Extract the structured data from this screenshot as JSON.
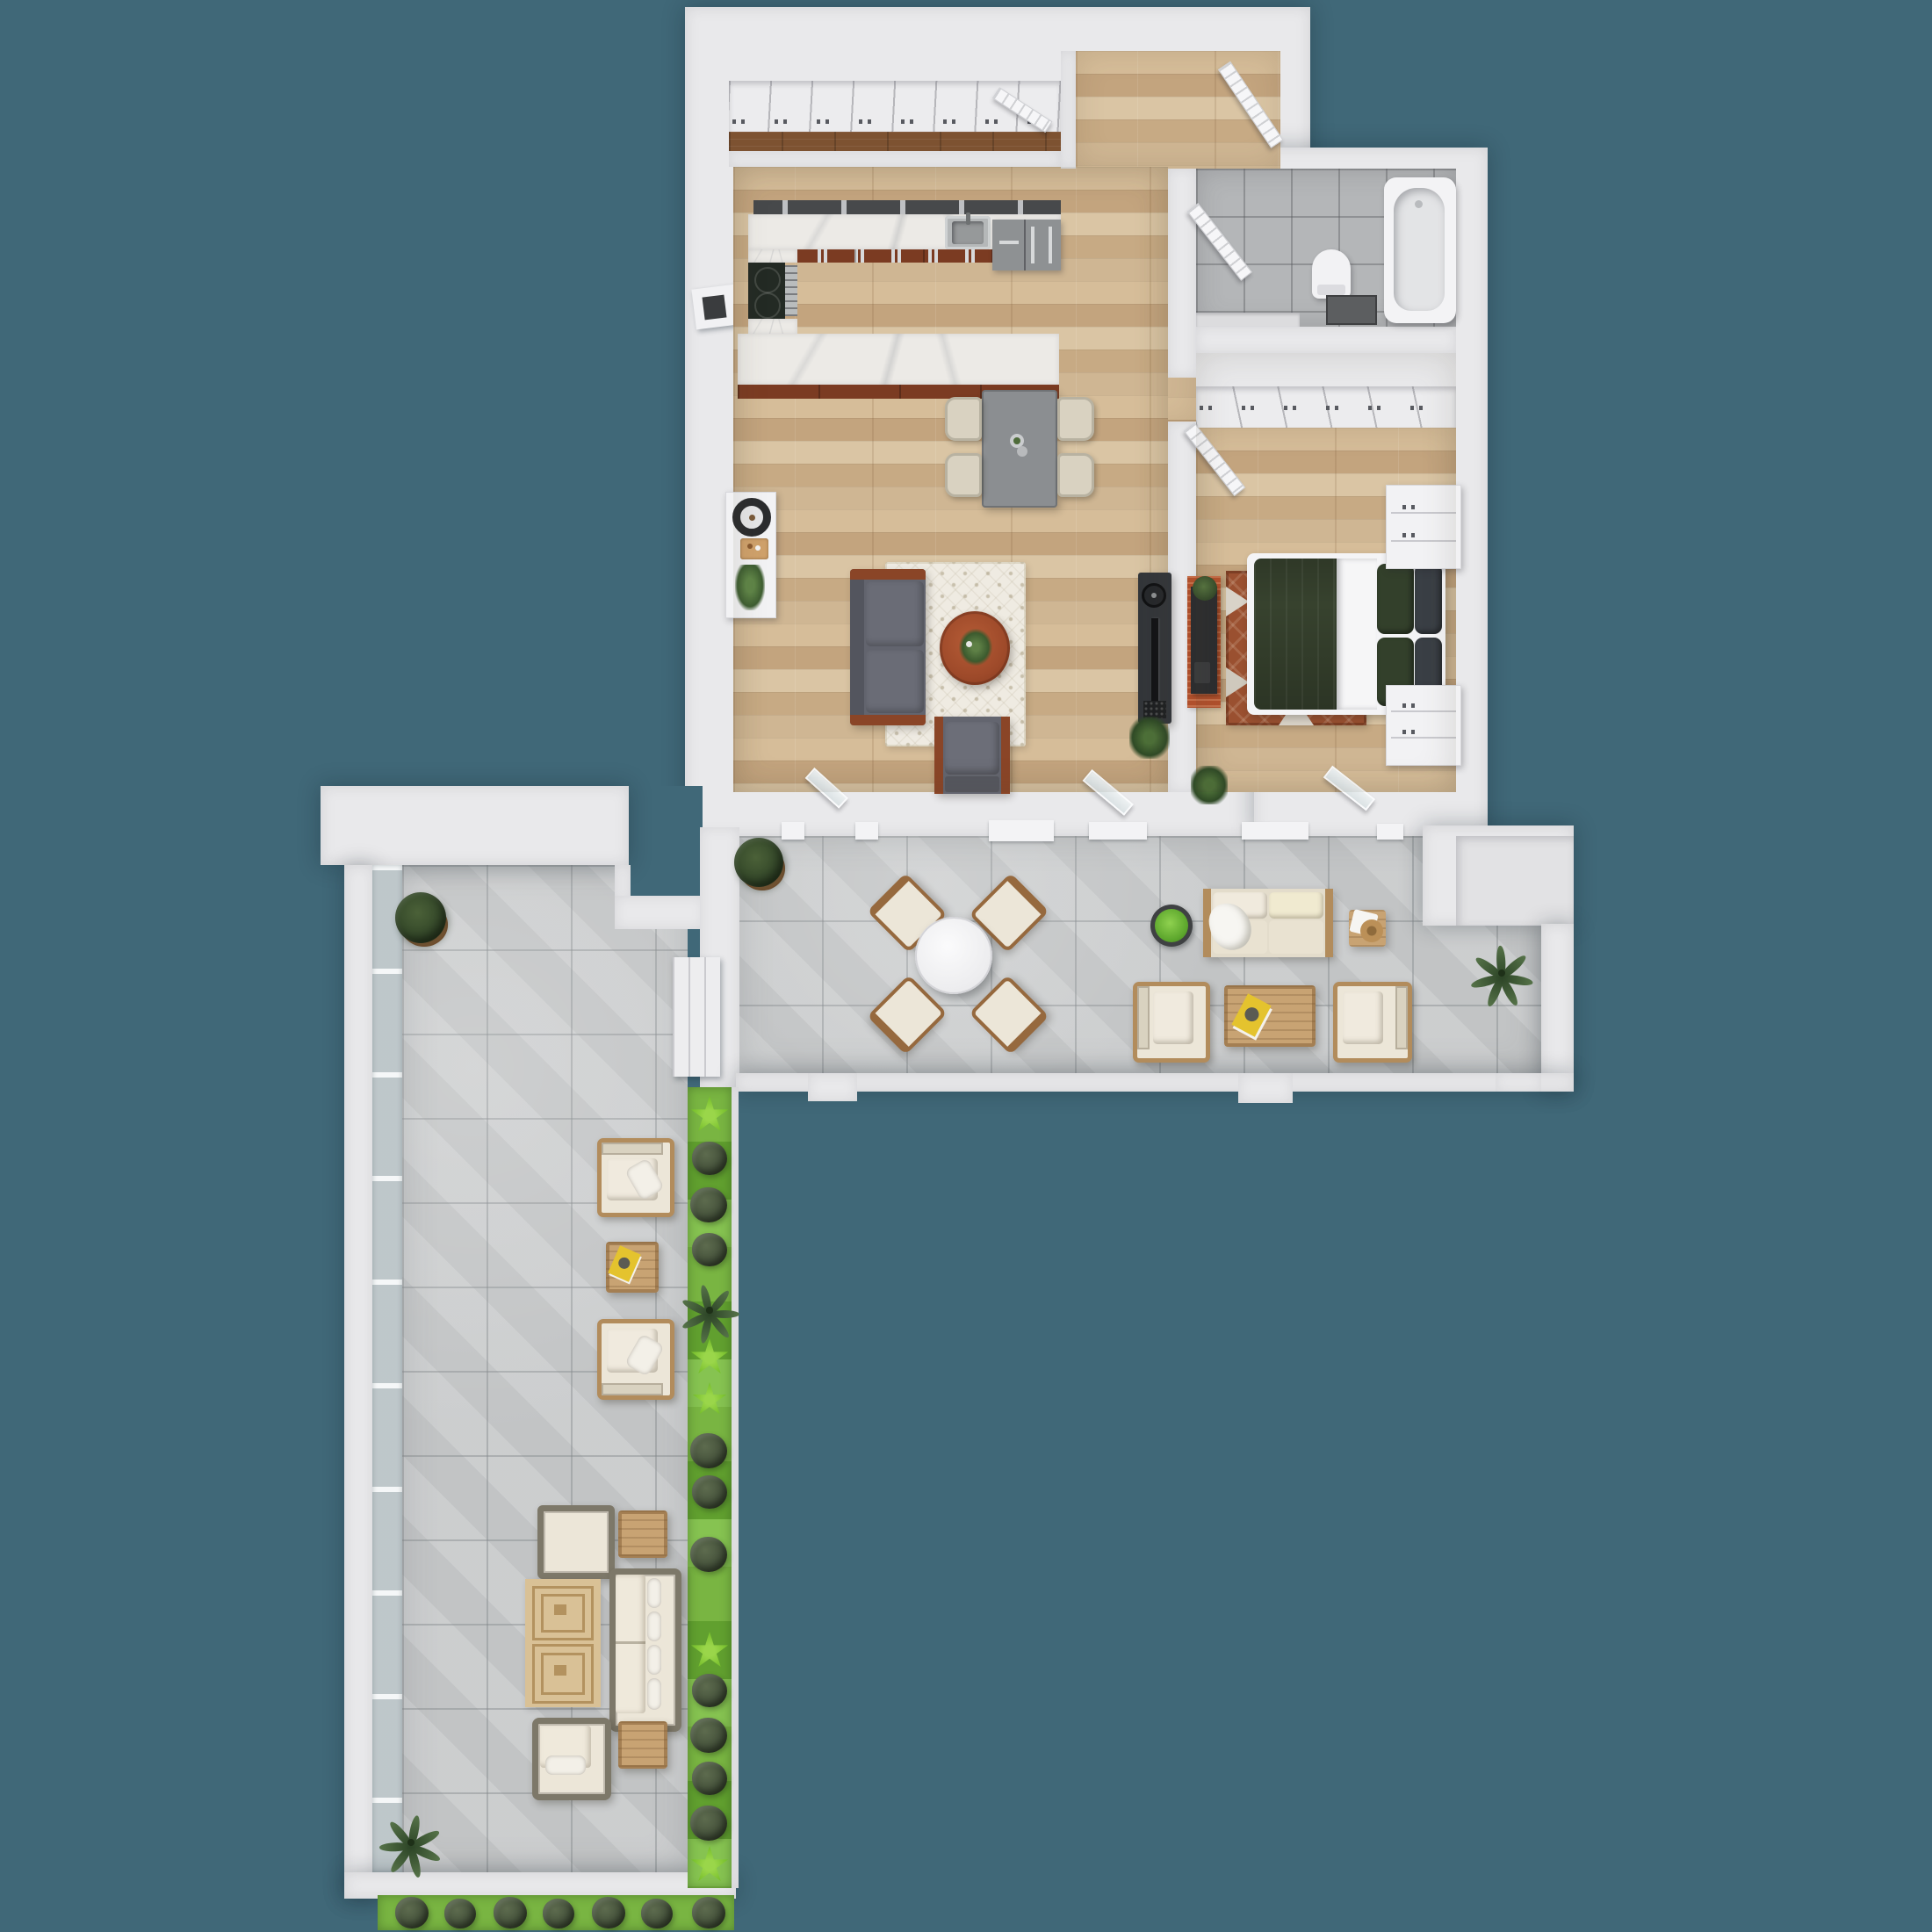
{
  "meta": {
    "title": "3D apartment floor plan render, top-down view",
    "view": "top-down",
    "visible_text": []
  },
  "palette": {
    "background": "#406878",
    "wall": "#e9e9eb",
    "wood_floor": "#cbb08a",
    "dark_wood_floor": "#7d5231",
    "terrace_tile": "#c9cbcc",
    "bath_tile": "#b4b6b8",
    "marble": "#eceae6",
    "backsplash": "#47494b",
    "cabinet_brown": "#7b3b22",
    "sofa_gray": "#62646e",
    "accent_wood": "#8a4527",
    "coffee_table_wood": "#9e4a2a",
    "bed_green": "#37422e",
    "bedroom_rug": "#9a5030",
    "outdoor_cream": "#ece6d8",
    "outdoor_wood": "#c8a373",
    "wicker": "#7d7869",
    "grass": "#68a83a",
    "plant_dark": "#3f5531",
    "plant_bright": "#7cc230",
    "magazine_yellow": "#e4c32e"
  },
  "scene": {
    "rooms": [
      {
        "name": "entry-hall"
      },
      {
        "name": "wardrobe-corridor"
      },
      {
        "name": "kitchen"
      },
      {
        "name": "living-dining-room"
      },
      {
        "name": "bedroom"
      },
      {
        "name": "bathroom"
      },
      {
        "name": "upper-terrace"
      },
      {
        "name": "garden-terrace-wing"
      }
    ],
    "furniture": {
      "kitchen": [
        "u-shaped-counter",
        "cooktop",
        "oven",
        "sink",
        "refrigerator",
        "bar-counter"
      ],
      "living": [
        "dining-table",
        "four-chairs",
        "gray-sofa",
        "round-coffee-table",
        "armchair",
        "patterned-rug",
        "tv-stand",
        "console-with-lamp",
        "plants"
      ],
      "bedroom": [
        "double-bed-green-duvet",
        "two-white-dressers",
        "wardrobe-row",
        "red-rug",
        "media-console",
        "plants"
      ],
      "bathroom": [
        "bathtub",
        "toilet",
        "vanity"
      ],
      "upper_terrace": [
        "round-dining-table",
        "four-wood-chairs",
        "outdoor-sofa",
        "two-outdoor-armchairs",
        "slat-coffee-table",
        "side-table-with-hat",
        "planter-pot",
        "boxwood-bush",
        "palm-plant"
      ],
      "terrace_wing": [
        "two-outdoor-armchairs",
        "side-table",
        "wicker-sofa",
        "wicker-armchair",
        "ottoman",
        "two-slat-side-tables",
        "double-square-rug",
        "boxwood-bush",
        "palm-plants",
        "planter-strips"
      ]
    }
  }
}
